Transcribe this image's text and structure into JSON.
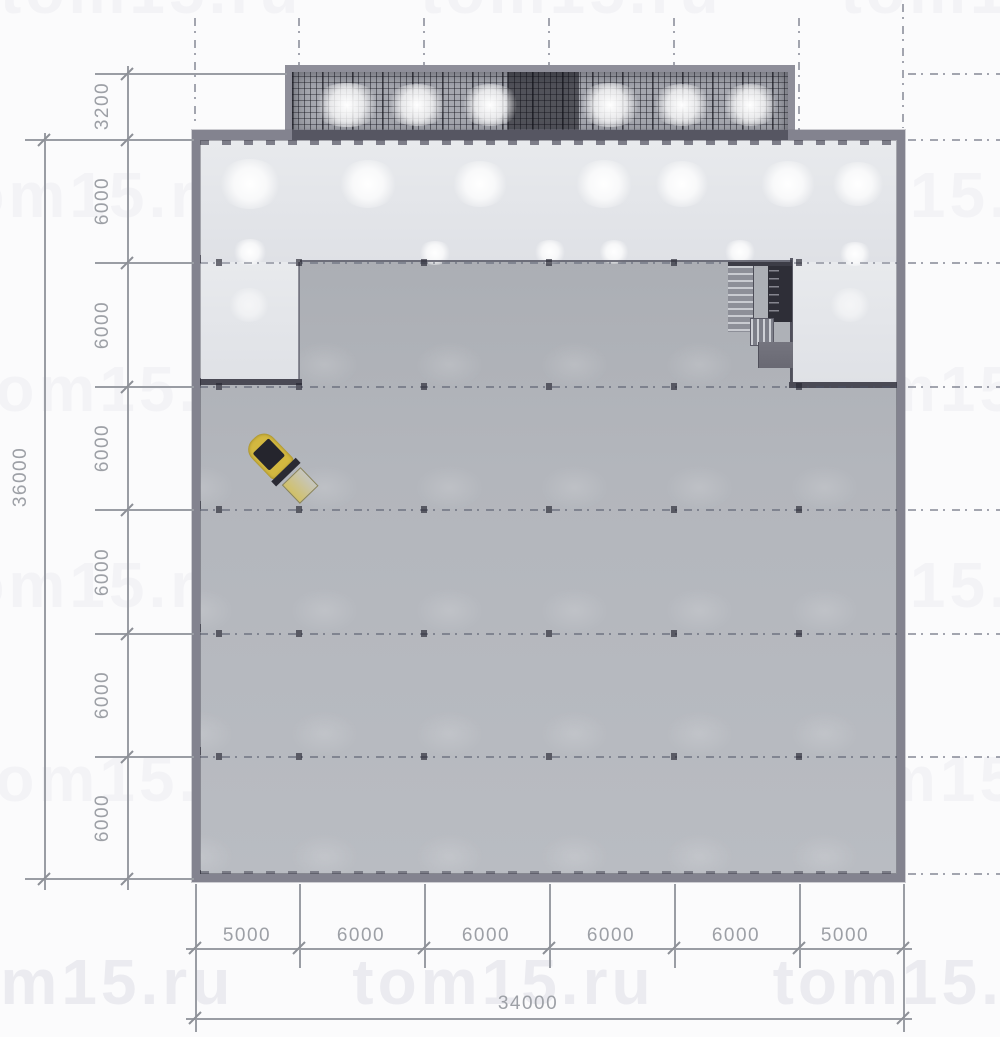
{
  "watermark": {
    "text": "tom15.ru"
  },
  "dimensions": {
    "left": {
      "canopy_depth": "3200",
      "bays": [
        "6000",
        "6000",
        "6000",
        "6000",
        "6000",
        "6000"
      ],
      "overall": "36000"
    },
    "bottom": {
      "bays": [
        "5000",
        "6000",
        "6000",
        "6000",
        "6000",
        "5000"
      ],
      "overall": "34000"
    }
  },
  "colors": {
    "wall": "#83838f",
    "floor": "#b0b3b9",
    "lit_zone": "#e6e8eb",
    "canopy_dark": "#2c2c34",
    "forklift_yellow": "#d3b840",
    "dimension_gray": "#9da0a6"
  }
}
